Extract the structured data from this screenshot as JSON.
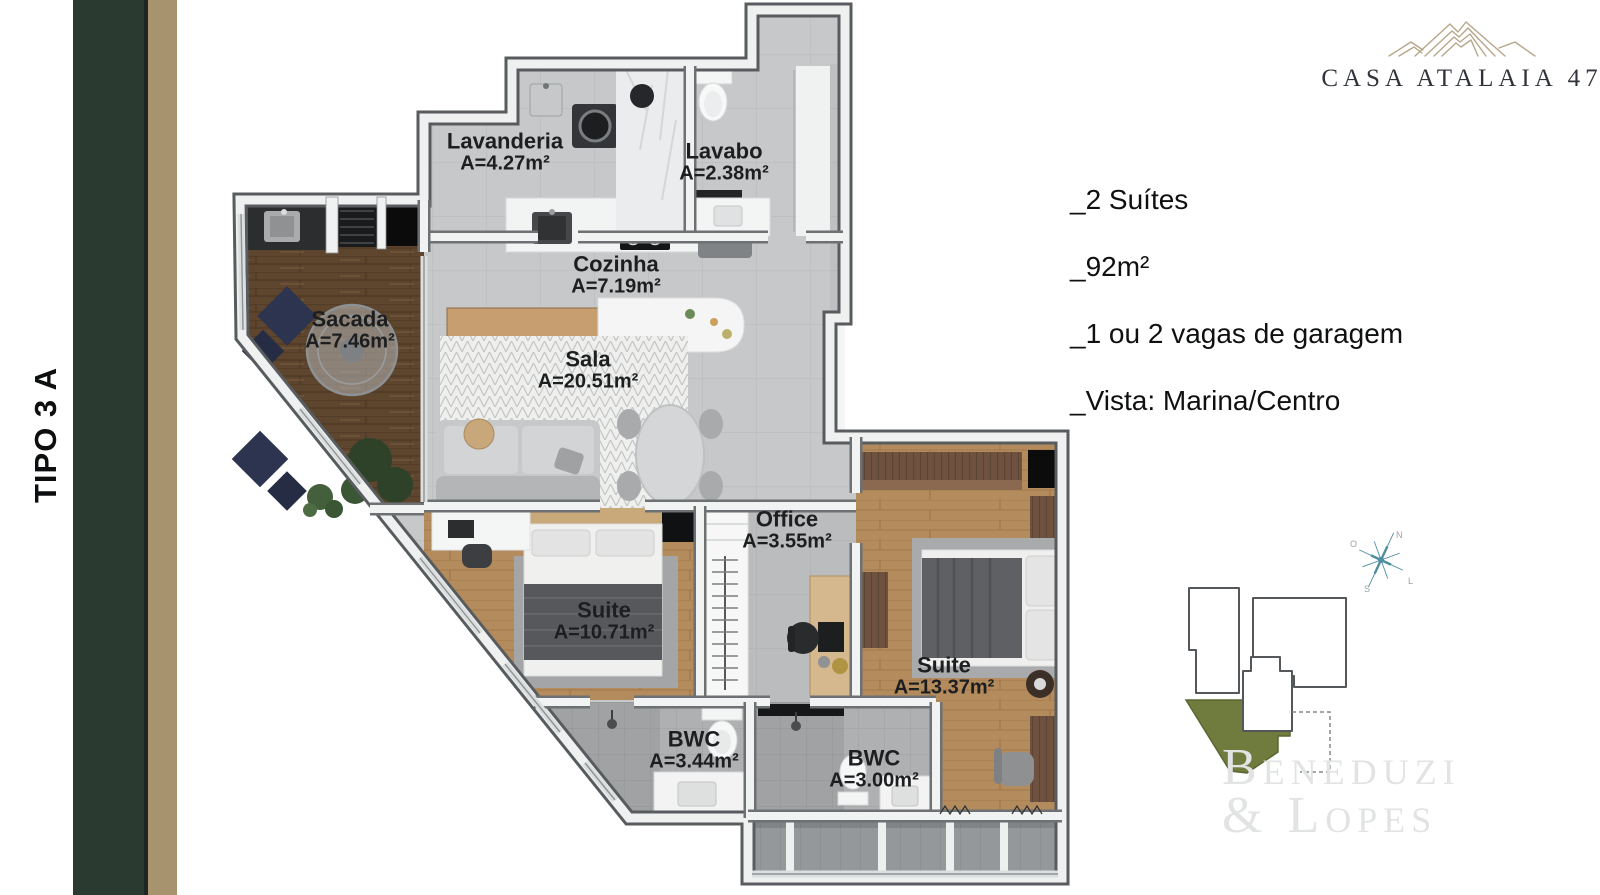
{
  "left_banner": {
    "type_label": "TIPO 3 A",
    "green_bar_color": "#2b3a31",
    "tan_bar_color": "#a7936e"
  },
  "brand": {
    "name": "CASA ATALAIA 47",
    "icon": "mountain-contours-icon",
    "text_color": "#30343a",
    "icon_color": "#b6a68a"
  },
  "specs": {
    "items": [
      {
        "text": "_2 Suítes"
      },
      {
        "text": "_92m²"
      },
      {
        "text": "_1 ou 2 vagas de garagem"
      },
      {
        "text": "_Vista: Marina/Centro"
      }
    ]
  },
  "floorplan": {
    "rooms": [
      {
        "name": "Lavanderia",
        "area": "A=4.27m²"
      },
      {
        "name": "Lavabo",
        "area": "A=2.38m²"
      },
      {
        "name": "Cozinha",
        "area": "A=7.19m²"
      },
      {
        "name": "Sacada",
        "area": "A=7.46m²"
      },
      {
        "name": "Sala",
        "area": "A=20.51m²"
      },
      {
        "name": "Office",
        "area": "A=3.55m²"
      },
      {
        "name": "Suite",
        "area": "A=10.71m²"
      },
      {
        "name": "Suite",
        "area": "A=13.37m²"
      },
      {
        "name": "BWC",
        "area": "A=3.44m²"
      },
      {
        "name": "BWC",
        "area": "A=3.00m²"
      }
    ]
  },
  "keyplan": {
    "highlight_color": "#6f7c3e",
    "outline_color": "#55585a",
    "compass": {
      "n": "N",
      "s": "S",
      "e": "L",
      "w": "O"
    }
  },
  "watermark": {
    "line1": "Beneduzi",
    "line2": "& Lopes"
  }
}
